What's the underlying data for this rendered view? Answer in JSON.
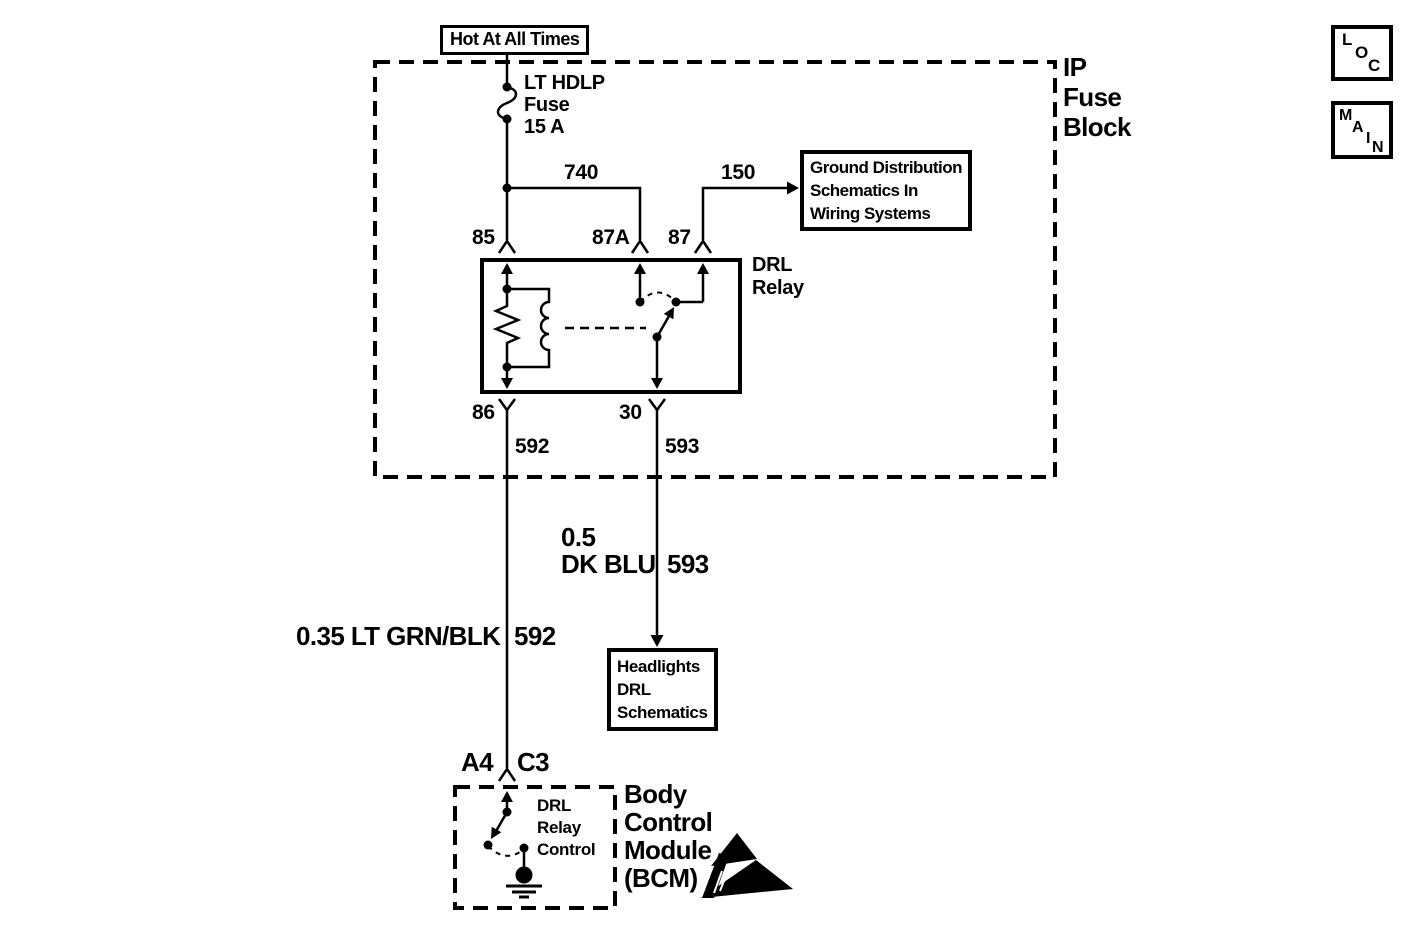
{
  "colors": {
    "ink": "#000000",
    "paper": "#ffffff"
  },
  "power_source": {
    "label": "Hot At All Times"
  },
  "fuse_block": {
    "label_lines": [
      "IP",
      "Fuse",
      "Block"
    ]
  },
  "fuse": {
    "label_lines": [
      "LT HDLP",
      "Fuse",
      "15 A"
    ]
  },
  "relay": {
    "name_lines": [
      "DRL",
      "Relay"
    ],
    "terminals": {
      "t85": "85",
      "t87a": "87A",
      "t87": "87",
      "t86": "86",
      "t30": "30"
    }
  },
  "wires": {
    "w740": "740",
    "w150": "150",
    "w592": "592",
    "w593": "593",
    "w593_spec": {
      "gauge": "0.5",
      "color": "DK BLU",
      "circuit": "593"
    },
    "w592_spec": {
      "gauge_color": "0.35 LT GRN/BLK",
      "circuit": "592"
    }
  },
  "references": {
    "ground_distribution": {
      "lines": [
        "Ground Distribution",
        "Schematics In",
        "Wiring Systems"
      ]
    },
    "headlights": {
      "lines": [
        "Headlights",
        "DRL",
        "Schematics"
      ]
    }
  },
  "bcm": {
    "pin": "A4",
    "connector": "C3",
    "switch_lines": [
      "DRL",
      "Relay",
      "Control"
    ],
    "name_lines": [
      "Body",
      "Control",
      "Module",
      "(BCM)"
    ]
  },
  "nav": {
    "loc_letters": [
      "L",
      "O",
      "C"
    ],
    "main_letters": [
      "M",
      "A",
      "I",
      "N"
    ]
  }
}
